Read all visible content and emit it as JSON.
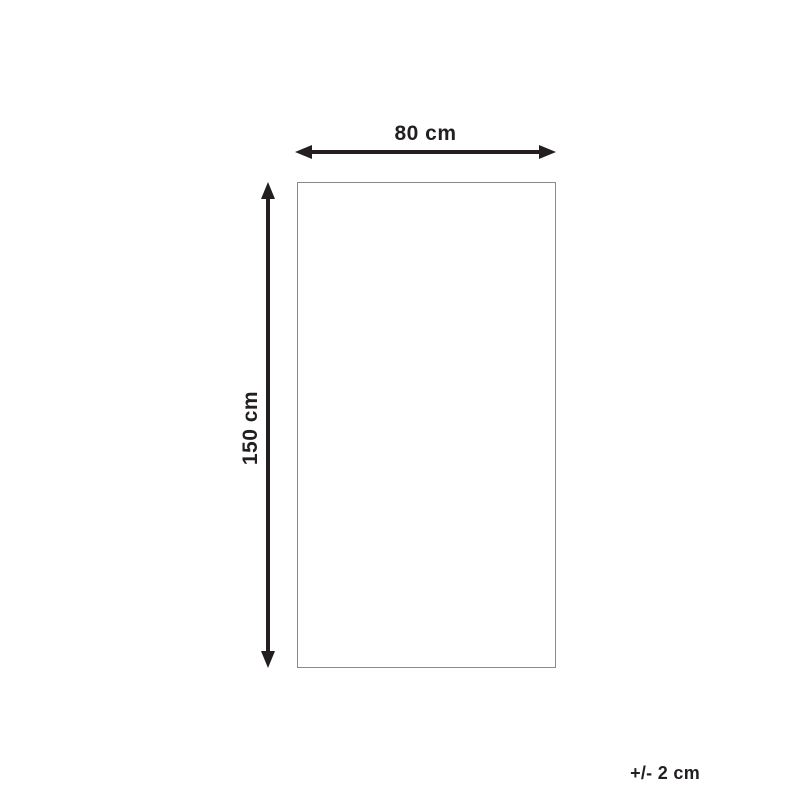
{
  "diagram": {
    "type": "product-dimension-diagram",
    "width_label": "80 cm",
    "height_label": "150 cm",
    "tolerance_label": "+/- 2 cm",
    "colors": {
      "background": "#ffffff",
      "arrow_and_text": "#231f20",
      "rectangle_border": "#8a8a8a"
    }
  }
}
